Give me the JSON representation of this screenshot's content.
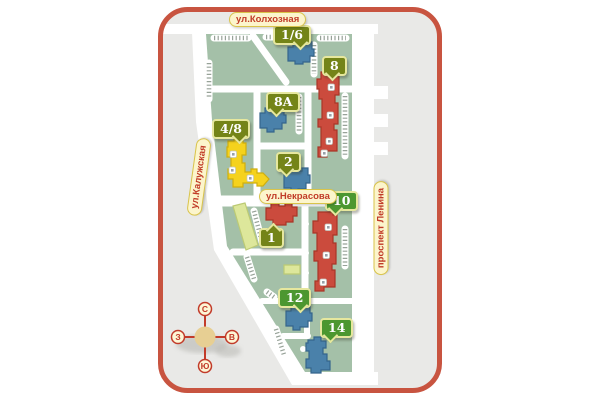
{
  "map": {
    "border_color": "#c85440",
    "background_color": "#e9e9e7",
    "block_color": "#a4c0a8",
    "road_color": "#ffffff",
    "street_label_style": {
      "background": "#fcf5cc",
      "border": "#d9c44a",
      "text": "#c13b27"
    },
    "streets": [
      {
        "id": "kolkhoznaya",
        "name": "ул.Колхозная",
        "orientation": "horizontal"
      },
      {
        "id": "kaluzhskaya",
        "name": "ул.Калужская",
        "orientation": "vertical"
      },
      {
        "id": "nekrasova",
        "name": "ул.Некрасова",
        "orientation": "horizontal"
      },
      {
        "id": "lenina",
        "name": "проспект Ленина",
        "orientation": "vertical"
      }
    ],
    "buildings": [
      {
        "label": "1/6",
        "building_color": "#4a81aa",
        "badge_color": "#748418"
      },
      {
        "label": "8",
        "building_color": "#cb4b3d",
        "badge_color": "#748418"
      },
      {
        "label": "8A",
        "building_color": "#4a81aa",
        "badge_color": "#748418"
      },
      {
        "label": "4/8",
        "building_color": "#f5d21d",
        "badge_color": "#748418"
      },
      {
        "label": "2",
        "building_color": "#4a81aa",
        "badge_color": "#748418"
      },
      {
        "label": "1",
        "building_color": "#cb4b3d",
        "badge_color": "#748418"
      },
      {
        "label": "10",
        "building_color": "#cb4b3d",
        "badge_color": "#4c9730"
      },
      {
        "label": "12",
        "building_color": "#4a81aa",
        "badge_color": "#4c9730"
      },
      {
        "label": "14",
        "building_color": "#4a81aa",
        "badge_color": "#4c9730"
      }
    ],
    "compass": {
      "north": "С",
      "east": "В",
      "south": "Ю",
      "west": "З"
    }
  }
}
